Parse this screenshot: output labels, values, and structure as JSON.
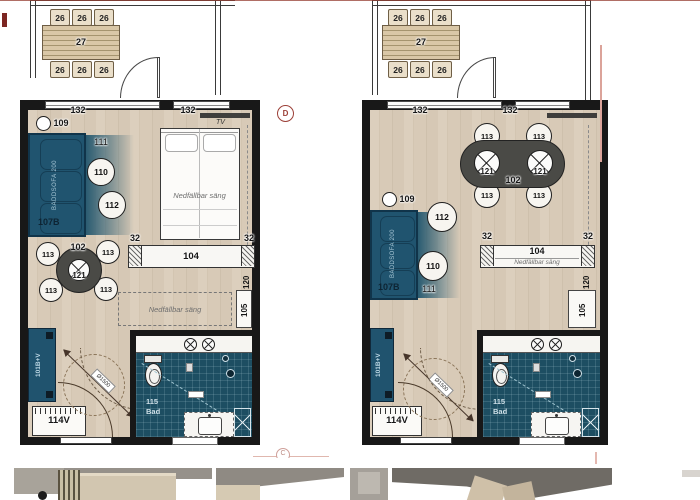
{
  "labels": {
    "balcony_table": "27",
    "balcony_chair": "26",
    "dim_width": "132",
    "dim_32": "32",
    "dim_104": "104",
    "dim_120": "120",
    "dim_105": "105",
    "keynote": "109",
    "tv": "TV",
    "rug": "111",
    "side_table": "110",
    "lounge_chair": "112",
    "sofa_id": "107B",
    "sofa_text": "BÄDDSOFA 200",
    "dining_table": "102",
    "spotlight": "121",
    "dining_chair": "113",
    "fold_bed": "Nedfällbar säng",
    "wardrobe": "101B+V",
    "hall_cabinet": "114V",
    "bath_number": "115",
    "bath_name": "Bad",
    "turning_radius": "Ø1500",
    "marker_d": "D",
    "marker_c": "C"
  },
  "colors": {
    "wall": "#181818",
    "sofa_blue": "#20546f",
    "tile_teal": "#1d4e62",
    "grid_red": "#9c4038",
    "wood": "#d6c8b5"
  }
}
